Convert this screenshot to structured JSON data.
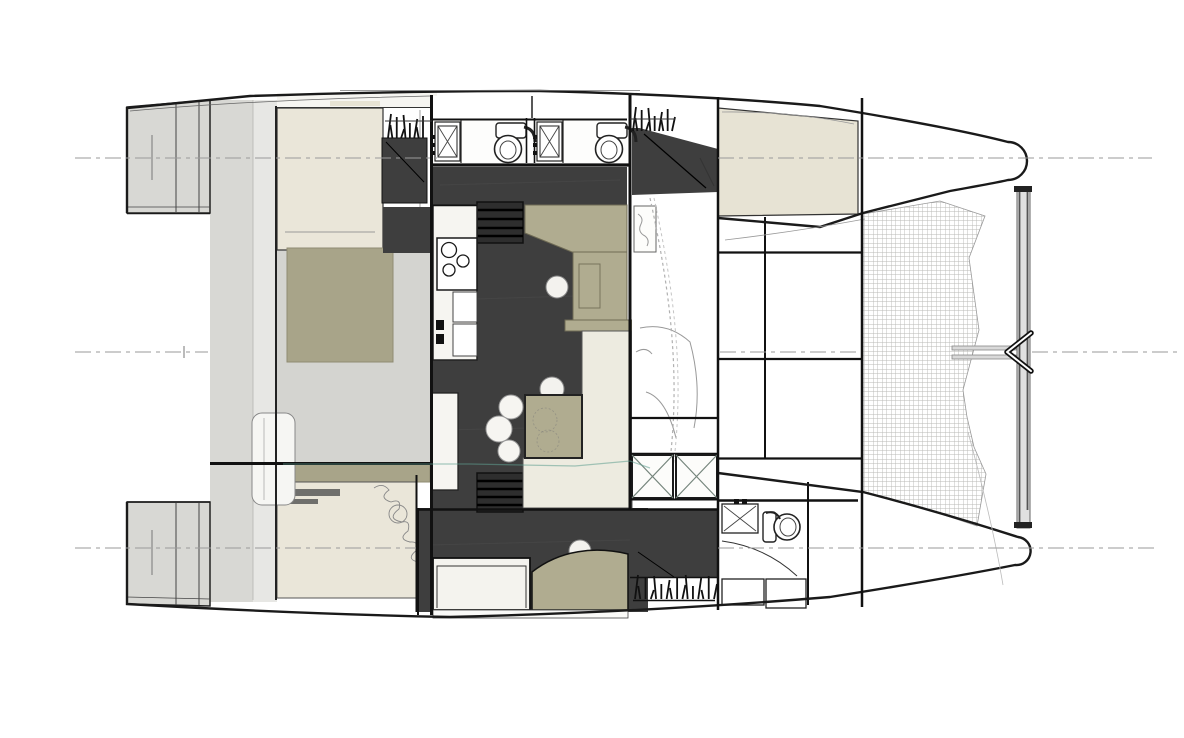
{
  "meta": {
    "title": "Catamaran interior layout — top-view floor plan",
    "description": "Architectural plan drawing of a sailing catamaran seen from above, bows to the right: twin hulls with transom steps, two heads with toilets and sinks, galley with cooktop, salon with table and stools, double berths, companionway stairs, forward trampoline mesh, forward crossbeam with bridle bracket, and dashed hull centerlines."
  },
  "colors": {
    "ink": "#1a1a1a",
    "charcoal": "#3e3e3e",
    "olive": "#b0ac90",
    "olive2": "#a8a489",
    "cream": "#eae6d9",
    "creamfloor": "#edebe0",
    "beige": "#e7e3d4",
    "deckgray": "#d4d4d0",
    "lightcol": "#e7e7e4",
    "blockgray": "#d8d8d4",
    "whitewarm": "#f6f5f1",
    "meshline": "#b8b8b6",
    "dashgray": "#9a9a9a",
    "teal": "#5f9f8f"
  },
  "features": [
    {
      "id": "port-hull",
      "label": "port hull (top)"
    },
    {
      "id": "starboard-hull",
      "label": "starboard hull (bottom)"
    },
    {
      "id": "port-transom-steps",
      "label": "transom steps aft"
    },
    {
      "id": "aft-cabin-berth",
      "label": "double berth"
    },
    {
      "id": "head-compartment",
      "label": "head with toilet and sink"
    },
    {
      "id": "galley",
      "label": "galley with cooktop and sink"
    },
    {
      "id": "salon",
      "label": "salon with table and stools"
    },
    {
      "id": "companionway-stairs",
      "label": "steps down into hull"
    },
    {
      "id": "hanging-locker",
      "label": "hanging locker"
    },
    {
      "id": "deck-hatch",
      "label": "deck hatch"
    },
    {
      "id": "trampoline",
      "label": "foredeck trampoline mesh"
    },
    {
      "id": "forward-crossbeam",
      "label": "forward crossbeam with bridle fitting"
    },
    {
      "id": "centerline",
      "label": "dashed centerlines"
    }
  ]
}
